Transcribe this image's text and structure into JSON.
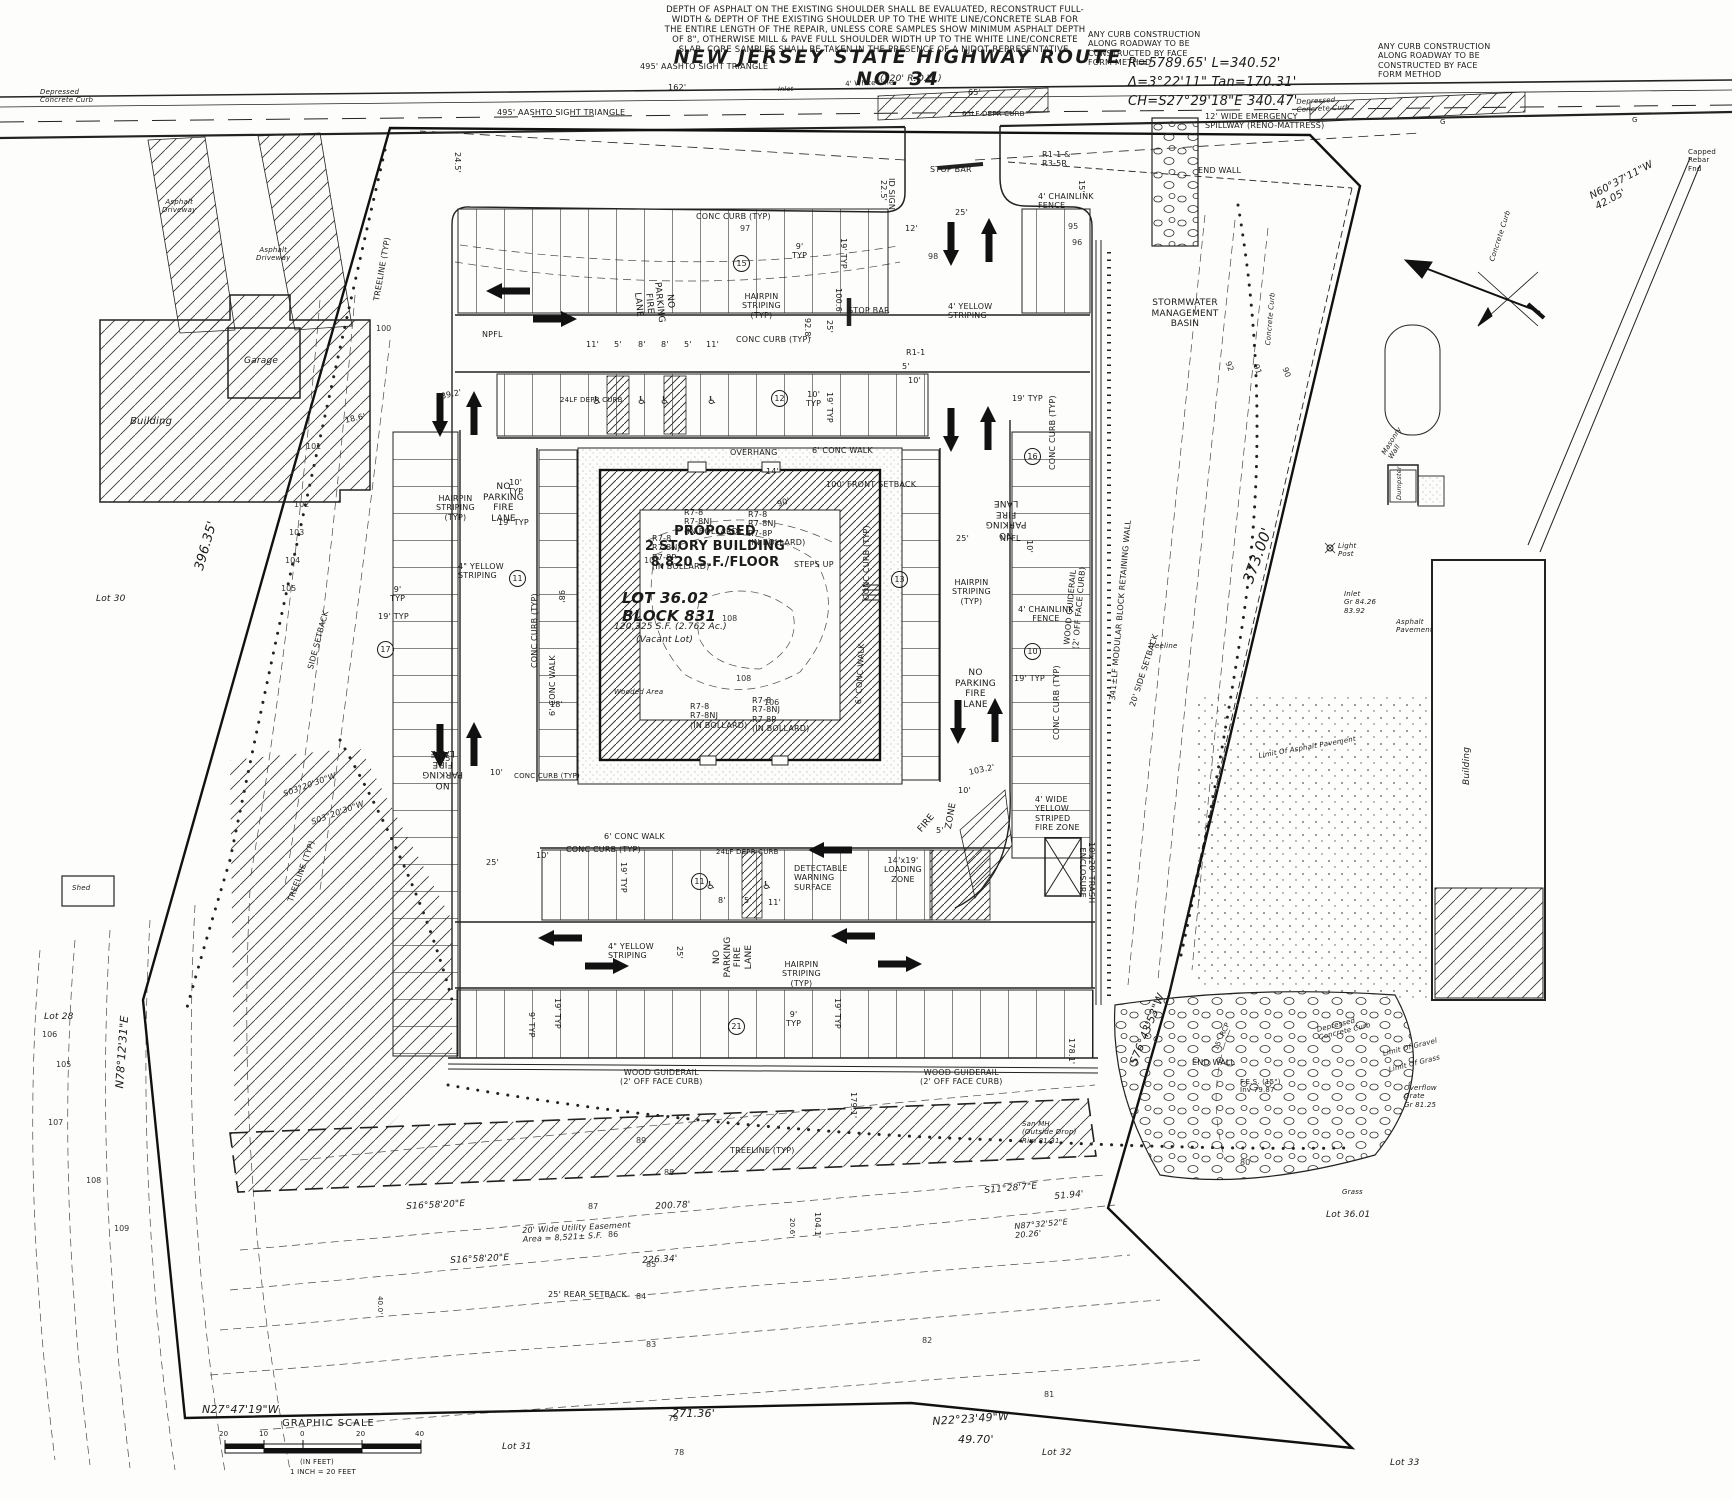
{
  "road": {
    "title": "NEW JERSEY STATE HIGHWAY ROUTE NO. 34",
    "row": "(120' R.O.W.)",
    "aashto": "495' AASHTO SIGHT TRIANGLE",
    "white_line": "4' White Line",
    "d162": "162'",
    "d65": "65'",
    "depr65": "65LF DEPR CURB",
    "g": "G",
    "inlet": "Inlet",
    "depressed_curb": "Depressed\nConcrete Curb",
    "concrete_curb": "Concrete Curb",
    "capped_rebar": "Capped\nRebar\nFnd"
  },
  "notes": {
    "asphalt": "DEPTH OF ASPHALT ON THE EXISTING SHOULDER SHALL BE EVALUATED, RECONSTRUCT FULL-\nWIDTH & DEPTH OF THE EXISTING SHOULDER UP TO THE WHITE LINE/CONCRETE SLAB FOR\nTHE ENTIRE LENGTH OF THE REPAIR, UNLESS CORE SAMPLES SHOW MINIMUM ASPHALT DEPTH\nOF 8\", OTHERWISE MILL & PAVE FULL SHOULDER WIDTH UP TO THE WHITE LINE/CONCRETE\nSLAB. CORE SAMPLES SHALL BE TAKEN IN THE PRESENCE OF A NJDOT REPRESENTATIVE.",
    "curb_construction": "ANY CURB CONSTRUCTION\nALONG ROADWAY TO BE\nCONSTRUCTED BY FACE\nFORM METHOD",
    "spillway": "12' WIDE EMERGENCY\nSPILLWAY (RENO-MATTRESS)",
    "curve": "R=5789.65'  L=340.52'\nΔ=3°22'11\"  Tan=170.31'\nCH=S27°29'18\"E  340.47'"
  },
  "signs": {
    "stop_bar": "STOP BAR",
    "r11_r35r": "R1-1 &\nR3-5R",
    "r1_1": "R1-1",
    "id_sign": "ID SIGN",
    "cluster3": "R7-8\nR7-8NJ\n(IN BOLLARD)",
    "cluster4": "R7-8\nR7-8NJ\nR7-8P\n(IN BOLLARD)"
  },
  "fire": {
    "npfl": "NO\nPARKING\nFIRE\nLANE",
    "npfl_short": "NPFL",
    "hairpin": "HAIRPIN\nSTRIPING\n(TYP)",
    "yellow_in": "4\" YELLOW\nSTRIPING",
    "yellow_ft": "4' YELLOW\nSTRIPING",
    "fire_zone_wide": "4' WIDE\nYELLOW\nSTRIPED\nFIRE ZONE",
    "fire_w": "FIRE",
    "zone_w": "ZONE"
  },
  "curbs": {
    "conc_curb": "CONC CURB (TYP)",
    "depr24": "24LF DEPR CURB",
    "conc_walk6": "6' CONC WALK",
    "wood_guiderail": "WOOD GUIDERAIL\n(2' OFF FACE CURB)",
    "retaining": "341±LF MODULAR BLOCK RETAINING WALL",
    "chainlink": "4' CHAINLINK\nFENCE"
  },
  "bldg": {
    "proposed": "PROPOSED\n2 STORY BUILDING\n8,820 S.F./FLOOR",
    "lot": "LOT 36.02\nBLOCK 831",
    "area": "120,325 S.F. (2.762 Ac.)",
    "vacant": "(Vacant Lot)",
    "steps": "STEPS UP",
    "wooded": "Wooded Area",
    "overhang": "OVERHANG",
    "front_setback": "100' FRONT SETBACK",
    "side_setback": "SIDE SETBACK",
    "side_setback20": "20' SIDE SETBACK",
    "rear_setback": "25' REAR SETBACK",
    "d90": "90'",
    "d98": "98'",
    "d14": "14'",
    "d18": "18'"
  },
  "features": {
    "basin": "STORMWATER\nMANAGEMENT\nBASIN",
    "end_wall": "END WALL",
    "fes": "F.E.S. (15\")\nInv 79.87",
    "rcp15": "15\" RCP",
    "overflow": "Overflow\nGrate\nGr 81.25",
    "san_mh": "San MH\n(Outside Drop)\nRim 81.31",
    "trash": "10'x20' TRASH\nENCLOSURE",
    "limit_gravel": "Limit Of Gravel",
    "limit_grass": "Limit Of Grass",
    "limit_asphalt": "Limit Of Asphalt Pavement",
    "masonry": "Masonry\nWall",
    "dumpster": "Dumpster",
    "light_post": "Light\nPost",
    "inlet": "Inlet\nGr 84.26\n83.92",
    "asphalt_pav": "Asphalt\nPavement",
    "treeline": "TREELINE (TYP)",
    "treeline_i": "Treeline",
    "loading": "14'x19'\nLOADING\nZONE",
    "dws": "DETECTABLE\nWARNING\nSURFACE",
    "easement": "20' Wide Utility Easement\nArea = 8,521± S.F.",
    "grass": "Grass"
  },
  "structures": {
    "garage": "Garage",
    "building": "Building",
    "shed": "Shed",
    "asphalt_dr": "Asphalt\nDriveway"
  },
  "bearings": {
    "b396": "396.35'",
    "n78": "N78°12'31\"E",
    "n27": "N27°47'19\"W",
    "d271": "271.36'",
    "n22": "N22°23'49\"W",
    "d4970": "49.70'",
    "b373": "373.00'",
    "s76": "S76°43'53\"W",
    "n60": "N60°37'11\"W\n42.05'",
    "s03": "S03°20'30\"W",
    "s16": "S16°58'20\"E",
    "d20078": "200.78'",
    "d22634": "226.34'",
    "s11": "S11°28'7\"E",
    "d5194": "51.94'",
    "n87": "N87°32'52\"E\n20.26'",
    "d1041": "104.1'",
    "d206": "20.6'",
    "d400": "40.0'",
    "d1791": "179.1'",
    "d1781": "178.1'"
  },
  "lots": {
    "lot28": "Lot 28",
    "lot30": "Lot 30",
    "lot31": "Lot 31",
    "lot32": "Lot 32",
    "lot33": "Lot 33",
    "lot3601": "Lot 36.01"
  },
  "dims": {
    "d9typ": "9'\nTYP",
    "d9typ1": "9' TYP",
    "d19typ": "19' TYP",
    "d10typ": "10'\nTYP",
    "d10": "10'",
    "d11": "11'",
    "d8": "8'",
    "d5": "5'",
    "d12": "12'",
    "d15": "15'",
    "d25": "25'",
    "d6": "6'",
    "d928": "92.8'",
    "d1006": "100.6'",
    "d892": "89.2'",
    "d186": "18.6'",
    "d245": "24.5'",
    "d225": "22.5'",
    "d1032": "103.2'"
  },
  "counts": {
    "c15": "15",
    "c12": "12",
    "c11": "11",
    "c17": "17",
    "c16": "16",
    "c13": "13",
    "c10": "10",
    "c21": "21"
  },
  "scale": {
    "title": "GRAPHIC SCALE",
    "t20": "20",
    "t10": "10",
    "t0": "0",
    "t20b": "20",
    "t40": "40",
    "infeet": "(IN FEET)",
    "inch": "1 INCH = 20 FEET"
  },
  "icons": {
    "wheelchair": "♿"
  },
  "contours": [
    "95",
    "96",
    "97",
    "98",
    "100",
    "101",
    "102",
    "103",
    "104",
    "105",
    "106",
    "105",
    "107",
    "108",
    "109",
    "89",
    "88",
    "87",
    "86",
    "85",
    "84",
    "83",
    "82",
    "81",
    "80",
    "79",
    "78",
    "92",
    "91",
    "90",
    "107",
    "108",
    "108",
    "106"
  ]
}
